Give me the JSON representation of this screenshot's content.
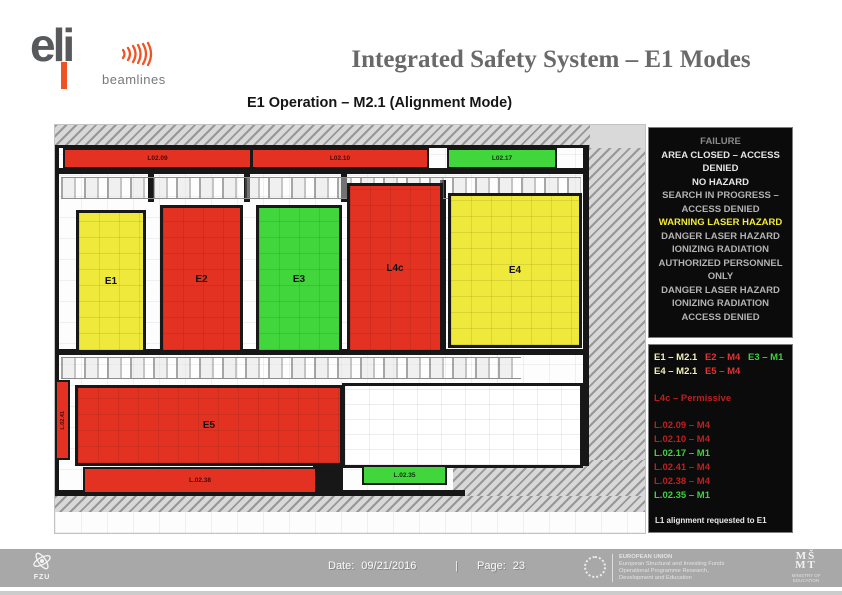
{
  "colors": {
    "accent-orange": "#f05323",
    "logo-gray": "#58595b",
    "title-gray": "#696969",
    "room-red": "#e43222",
    "room-yellow": "#efe93c",
    "room-green": "#41d63b",
    "wall": "#171717",
    "panel-bg": "#0b0b0b",
    "status-dim": "#8a8a8a",
    "status-mid": "#b2b2b2",
    "status-bright": "#e6e6e6",
    "status-yellow": "#f2ea30",
    "legend-pale-yellow": "#f5f0b5",
    "legend-red": "#e03333",
    "legend-dark-red": "#bb2020",
    "legend-green": "#3fd03f",
    "footer-bg": "#a8a8a8"
  },
  "header": {
    "logo_word": "eli",
    "logo_sub": "beamlines",
    "title": "Integrated Safety System – E1 Modes",
    "subtitle": "E1 Operation – M2.1 (Alignment Mode)"
  },
  "plan": {
    "rooms": [
      {
        "id": "E1",
        "label": "E1",
        "mode": "yellow"
      },
      {
        "id": "E2",
        "label": "E2",
        "mode": "red"
      },
      {
        "id": "E3",
        "label": "E3",
        "mode": "green"
      },
      {
        "id": "L4c",
        "label": "L4c",
        "mode": "red"
      },
      {
        "id": "E4",
        "label": "E4",
        "mode": "yellow"
      },
      {
        "id": "E5",
        "label": "E5",
        "mode": "red"
      }
    ],
    "corridors": [
      {
        "id": "L02.09",
        "label": "L02.09",
        "mode": "red"
      },
      {
        "id": "L02.10",
        "label": "L02.10",
        "mode": "red"
      },
      {
        "id": "L02.17",
        "label": "L02.17",
        "mode": "green"
      },
      {
        "id": "L02.41",
        "label": "L.02.41",
        "mode": "red"
      },
      {
        "id": "L02.38",
        "label": "L.02.38",
        "mode": "red"
      },
      {
        "id": "L02.35",
        "label": "L.02.35",
        "mode": "green"
      }
    ]
  },
  "status_panel": {
    "items": [
      {
        "text": "FAILURE",
        "tone": "dim"
      },
      {
        "text": "AREA CLOSED – ACCESS DENIED",
        "tone": "bright"
      },
      {
        "text": "NO HAZARD",
        "tone": "bright"
      },
      {
        "text": "SEARCH IN PROGRESS – ACCESS DENIED",
        "tone": "mid"
      },
      {
        "text": "WARNING LASER HAZARD",
        "tone": "yellow"
      },
      {
        "text": "DANGER LASER HAZARD",
        "tone": "mid"
      },
      {
        "text": "IONIZING RADIATION",
        "tone": "mid"
      },
      {
        "text": "AUTHORIZED PERSONNEL ONLY",
        "tone": "mid"
      },
      {
        "text": "DANGER LASER HAZARD",
        "tone": "mid"
      },
      {
        "text": "IONIZING RADIATION",
        "tone": "mid"
      },
      {
        "text": "ACCESS DENIED",
        "tone": "mid"
      }
    ]
  },
  "legend_panel": {
    "row1": [
      {
        "text": "E1 – M2.1",
        "tone": "pale-yellow"
      },
      {
        "text": "E2 – M4",
        "tone": "red"
      },
      {
        "text": "E3 – M1",
        "tone": "green"
      }
    ],
    "row2": [
      {
        "text": "E4 – M2.1",
        "tone": "pale-yellow"
      },
      {
        "text": "E5 – M4",
        "tone": "red"
      }
    ],
    "l4c": {
      "text": "L4c – Permissive",
      "tone": "dark-red"
    },
    "lines": [
      {
        "text": "L.02.09 – M4",
        "tone": "dark-red"
      },
      {
        "text": "L.02.10 – M4",
        "tone": "dark-red"
      },
      {
        "text": "L.02.17 – M1",
        "tone": "green"
      },
      {
        "text": "L.02.41 – M4",
        "tone": "dark-red"
      },
      {
        "text": "L.02.38 – M4",
        "tone": "dark-red"
      },
      {
        "text": "L.02.35 – M1",
        "tone": "green"
      }
    ],
    "note": "L1 alignment requested to E1"
  },
  "footer": {
    "fzu_label": "FZU",
    "date_label": "Date:",
    "date_value": "09/21/2016",
    "separator": "|",
    "page_label": "Page:",
    "page_value": "23",
    "eu_lines": [
      "EUROPEAN UNION",
      "European Structural and Investing Funds",
      "Operational Programme Research,",
      "Development and Education"
    ],
    "msmt_top": "MŠ",
    "msmt_bottom": "MT",
    "msmt_caption": "MINISTRY OF EDUCATION"
  }
}
